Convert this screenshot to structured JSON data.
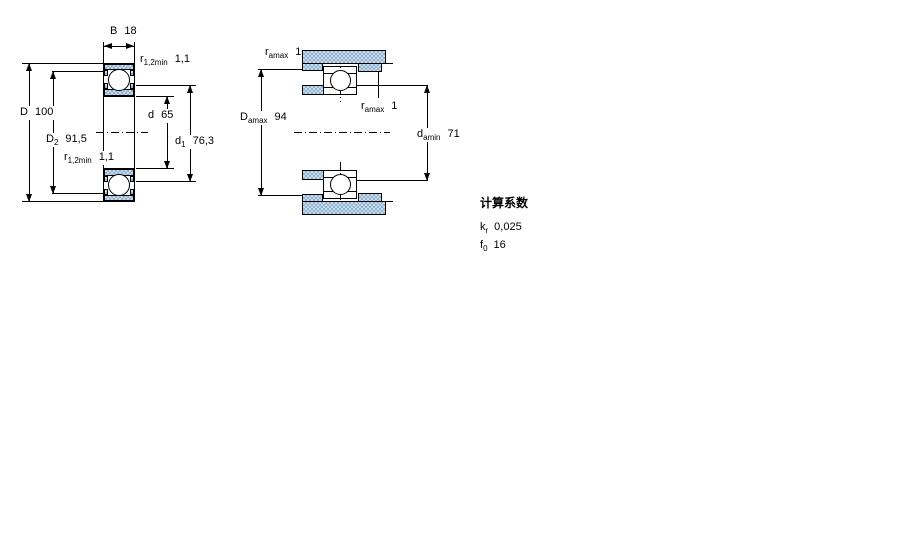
{
  "figure1": {
    "labels": {
      "B": {
        "symbol": "B",
        "sub": "",
        "value": "18"
      },
      "r_top": {
        "symbol": "r",
        "sub": "1,2min",
        "value": "1,1"
      },
      "D": {
        "symbol": "D",
        "sub": "",
        "value": "100"
      },
      "D2": {
        "symbol": "D",
        "sub": "2",
        "value": "91,5"
      },
      "d": {
        "symbol": "d",
        "sub": "",
        "value": "65"
      },
      "d1": {
        "symbol": "d",
        "sub": "1",
        "value": "76,3"
      },
      "r_bottom": {
        "symbol": "r",
        "sub": "1,2min",
        "value": "1,1"
      }
    }
  },
  "figure2": {
    "labels": {
      "ra_top": {
        "symbol": "r",
        "sub": "amax",
        "value": "1"
      },
      "Da": {
        "symbol": "D",
        "sub": "amax",
        "value": "94"
      },
      "ra_side": {
        "symbol": "r",
        "sub": "amax",
        "value": "1"
      },
      "da": {
        "symbol": "d",
        "sub": "amin",
        "value": "71"
      }
    }
  },
  "factors": {
    "title": "计算系数",
    "kr": {
      "symbol": "k",
      "sub": "r",
      "value": "0,025"
    },
    "f0": {
      "symbol": "f",
      "sub": "0",
      "value": "16"
    }
  },
  "colors": {
    "steel_light": "#c9dbe9",
    "steel_dark": "#8fb3d1",
    "line": "#000000",
    "background": "#ffffff"
  }
}
